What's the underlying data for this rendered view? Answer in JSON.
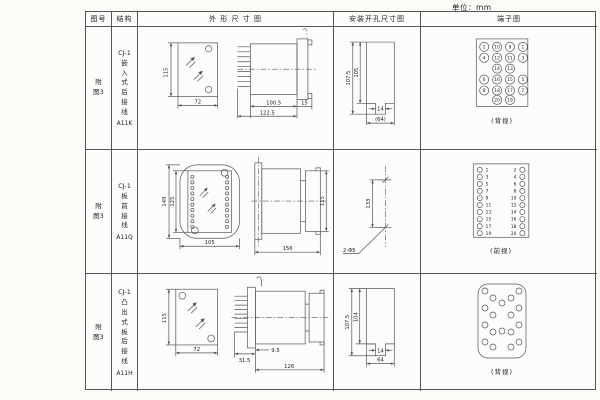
{
  "unit_label": "单位：mm",
  "header": {
    "figure": "图号",
    "structure": "结构",
    "outline": "外 形 尺 寸 图",
    "mounting": "安装开孔尺寸图",
    "terminal": "端子图"
  },
  "rows": [
    {
      "figure_no": "附图3",
      "structure_model": "CJ-1",
      "structure_desc": "嵌入式后接线",
      "structure_code": "A11K",
      "outline": {
        "front_height": "115",
        "front_width": "72",
        "body_length": "100.5",
        "total_length": "122.5",
        "flange_depth": "15"
      },
      "mounting": {
        "outer_height": "107.5",
        "inner_height": "105",
        "slot_width": "14",
        "hole_spacing": "(64)"
      },
      "terminal": {
        "caption": "(背视)",
        "nums": [
          "2",
          "10",
          "9",
          "1",
          "4",
          "12",
          "11",
          "3",
          "14",
          "13",
          "6",
          "16",
          "15",
          "5",
          "8",
          "18",
          "17",
          "7",
          "20",
          "19"
        ]
      }
    },
    {
      "figure_no": "附图3",
      "structure_model": "CJ-1",
      "structure_desc": "板前接线",
      "structure_code": "A11Q",
      "outline": {
        "flange_height": "149",
        "body_height": "125",
        "front_width": "105",
        "total_length": "156",
        "side_height": "115"
      },
      "mounting": {
        "hole_spacing": "133",
        "hole_label": "2-Φ5"
      },
      "terminal": {
        "caption": "(前视)",
        "left": [
          "1",
          "3",
          "5",
          "7",
          "9",
          "11",
          "13",
          "15",
          "17",
          "19"
        ],
        "right": [
          "2",
          "4",
          "6",
          "8",
          "10",
          "12",
          "14",
          "16",
          "18",
          "20"
        ]
      }
    },
    {
      "figure_no": "附图3",
      "structure_model": "CJ-1",
      "structure_desc": "凸出式板后接线",
      "structure_code": "A11H",
      "outline": {
        "front_height": "115",
        "front_width": "72",
        "pin_length": "31.5",
        "plate_depth": "9.5",
        "body_length": "126"
      },
      "mounting": {
        "outer_height": "107.5",
        "inner_height": "104",
        "slot_width": "14",
        "hole_spacing": "64"
      },
      "terminal": {
        "caption": "(背视)"
      }
    }
  ]
}
